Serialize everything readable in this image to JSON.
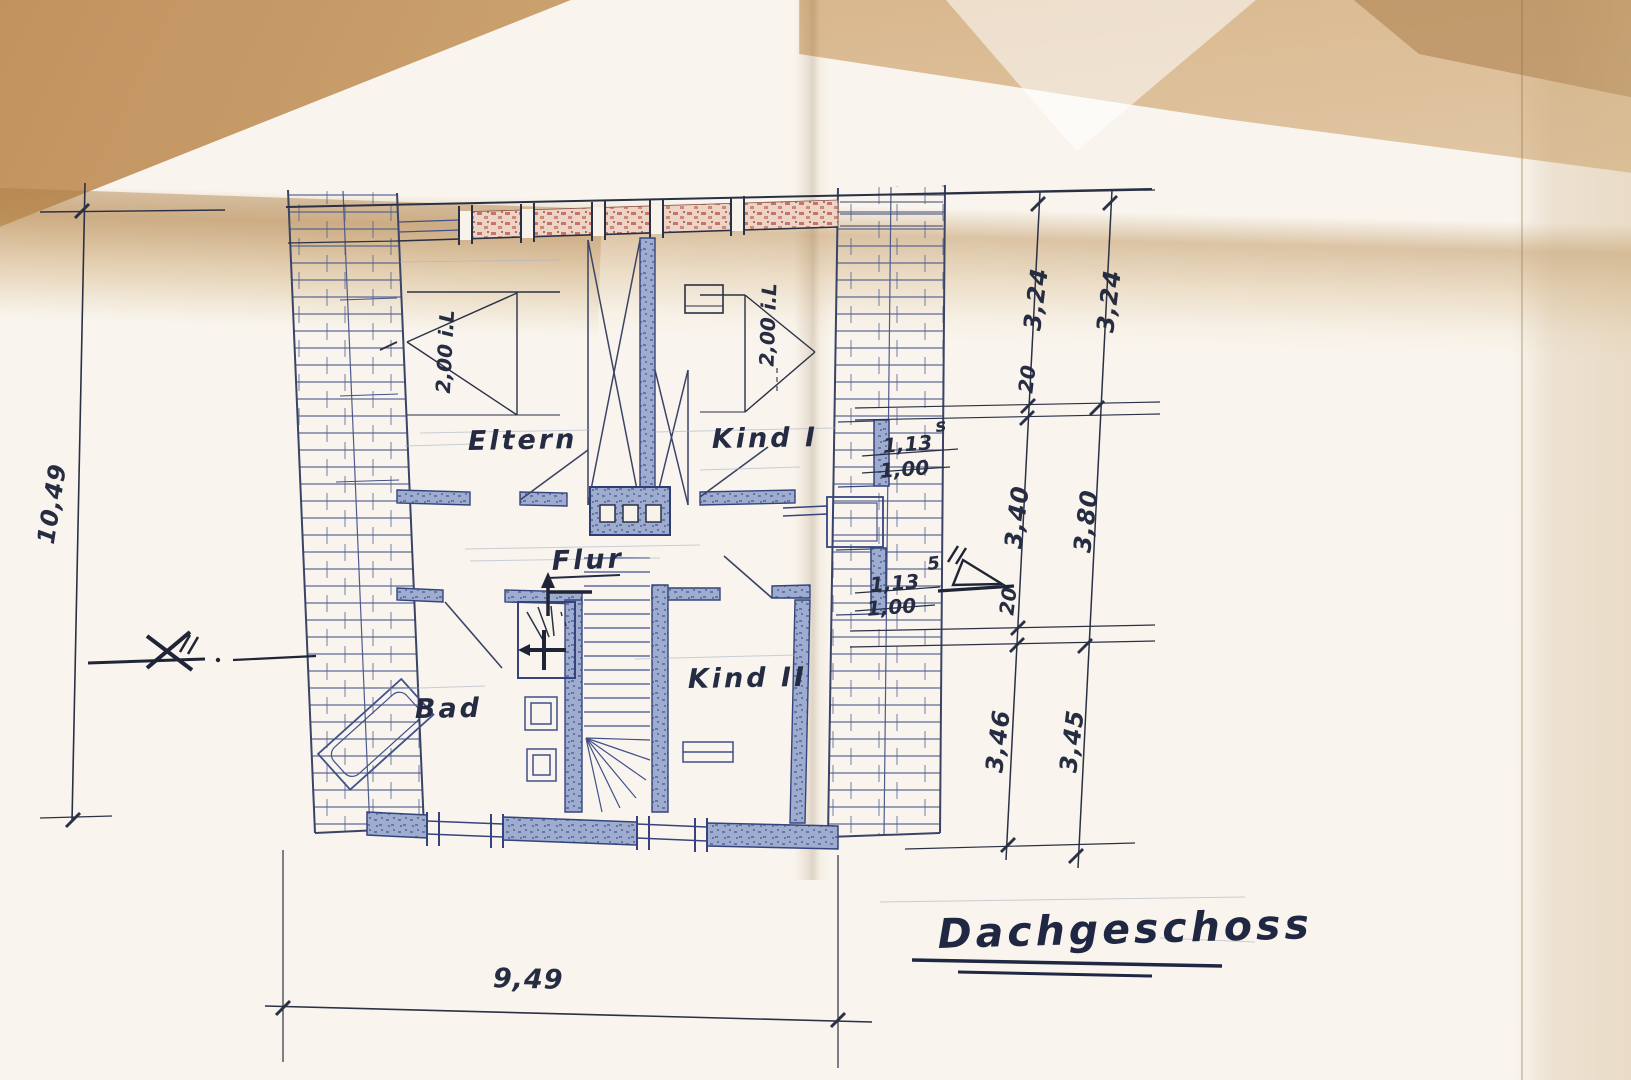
{
  "plan": {
    "title": "Dachgeschoss",
    "rooms": {
      "eltern": "Eltern",
      "kind1": "Kind I",
      "flur": "Flur",
      "bad": "Bad",
      "kind2": "Kind II"
    },
    "dims": {
      "left_total": "10,49",
      "bottom_total": "9,49",
      "right_inner": [
        "3,24",
        "20",
        "3,40",
        "20",
        "3,46"
      ],
      "right_outer": [
        "3,24",
        "3,80",
        "3,45"
      ],
      "win1_a": "1,13",
      "win1_b": "1,00",
      "win1_sup": "s",
      "win2_a": "1,13",
      "win2_b": "1,00",
      "win2_sup": "5",
      "clear_left": "2,00 i.L",
      "clear_right": "2,00 i.L"
    },
    "colors": {
      "ink_dark": "#2a3145",
      "ink_blue": "#40508a",
      "wall_fill": "#9daccf",
      "brick_red": "#c4756b",
      "paper": "#f9f5ee",
      "crease_tan": "#c79b63"
    }
  }
}
